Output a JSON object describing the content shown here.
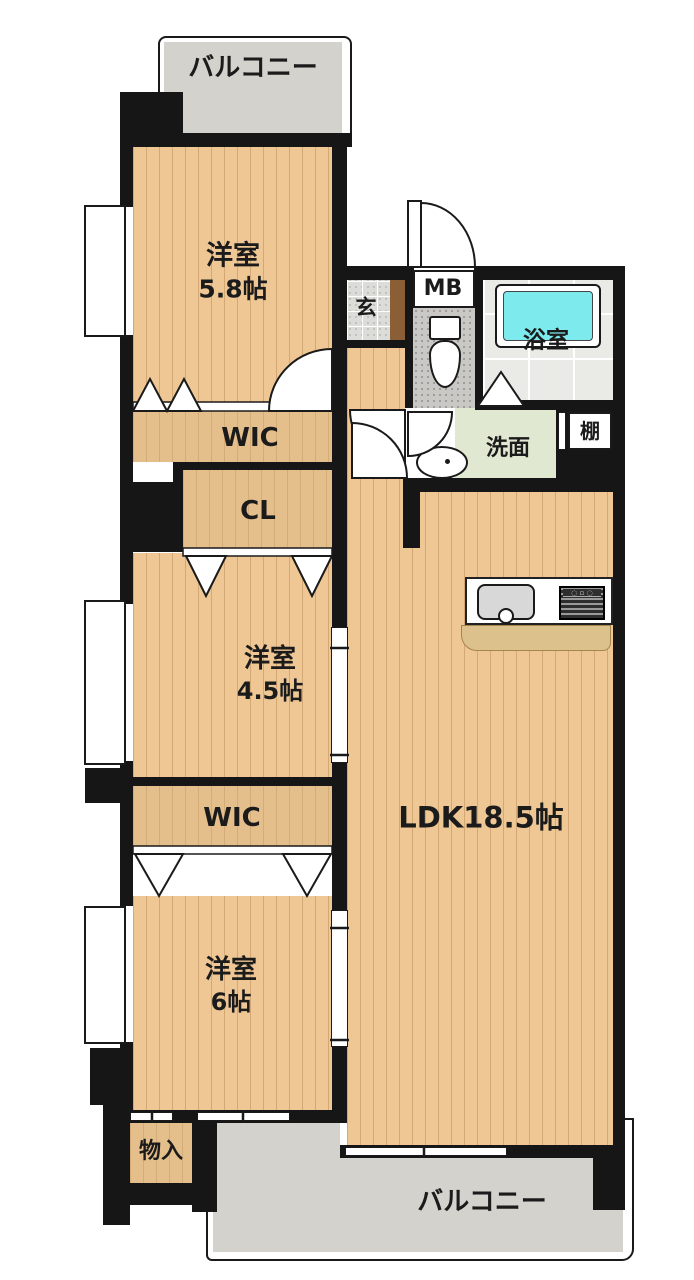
{
  "floorplan": {
    "labels": {
      "balcony_top": "バルコニー",
      "room1_name": "洋室",
      "room1_size": "5.8帖",
      "genkan": "玄",
      "meter_box": "MB",
      "bath": "浴室",
      "wic1": "WIC",
      "washroom": "洗面",
      "shelf": "棚",
      "closet": "CL",
      "room2_name": "洋室",
      "room2_size": "4.5帖",
      "ldk": "LDK18.5帖",
      "wic2": "WIC",
      "room3_name": "洋室",
      "room3_size": "6帖",
      "storage": "物入",
      "balcony_bottom": "バルコニー"
    },
    "colors": {
      "wall": "#161616",
      "wood": "#eec795",
      "closet": "#e4bf8c",
      "balcony": "#d3d2cd",
      "tub": "#7debee",
      "washroom": "#e0e8d2",
      "counter": "#ddc18c",
      "step": "#8a5f35",
      "bathtile": "#eaeae7",
      "genkan": "#dcdcd8",
      "toiletfloor": "#c9c8c5"
    }
  }
}
